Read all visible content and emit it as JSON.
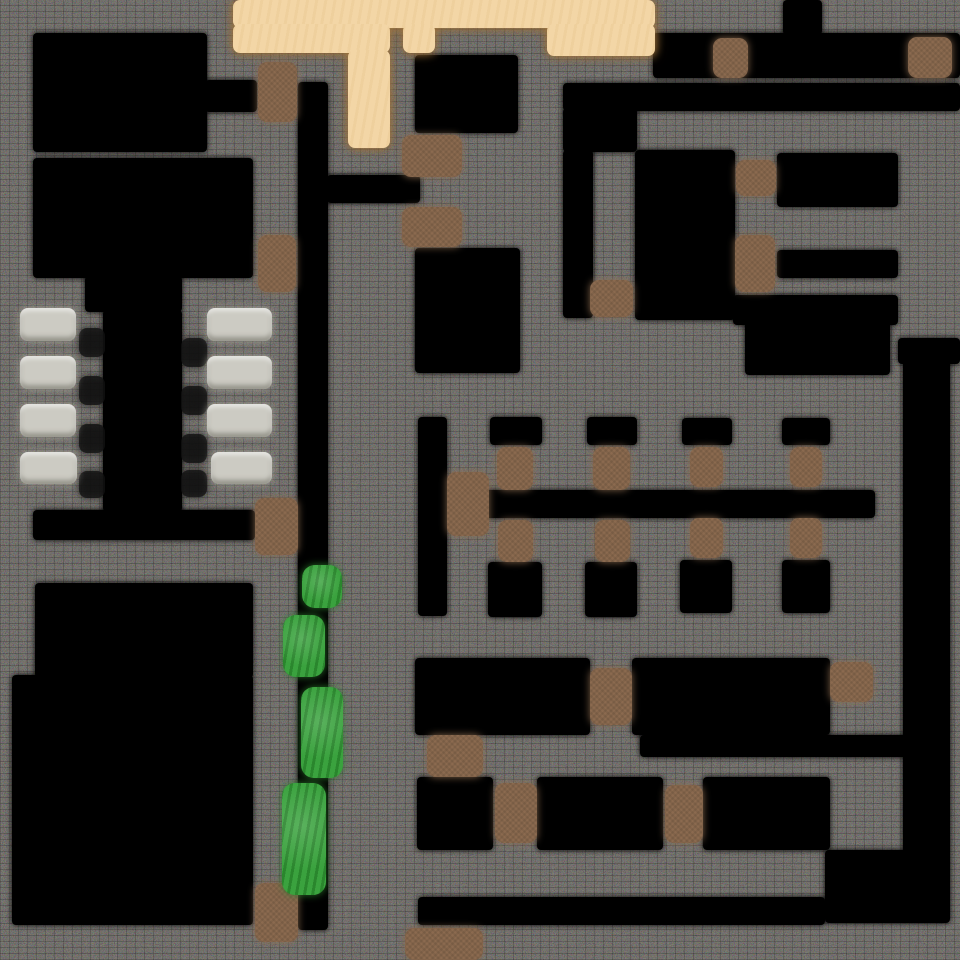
{
  "scene": {
    "title": "top-down tile map",
    "width": 960,
    "height": 960,
    "wall_background": "#1f1e1c"
  },
  "legend": {
    "floor": "room interior / corridor floor",
    "sand": "sandy plaza ground",
    "door": "wooden door",
    "bed": "bed / pew row",
    "bush": "bush shrub",
    "furniture": "small dark furniture"
  },
  "palette": {
    "floor": "#000000",
    "sand": "#f3d6a6",
    "sand_shadow": "#ab7a3d",
    "door": "#8b6a4f",
    "bed": "#cccbc3",
    "bush": "#3aa23e",
    "furniture": "#121212"
  },
  "map": {
    "layers": [
      {
        "id": "floor",
        "kind": "floor",
        "interactable": false,
        "color": "#000000",
        "items": [
          {
            "name": "room-nw-a",
            "rect": [
              33,
              33,
              174,
              119
            ]
          },
          {
            "name": "corridor-nw-door",
            "rect": [
              205,
              80,
              52,
              32
            ]
          },
          {
            "name": "corridor-west-vertical",
            "rect": [
              298,
              82,
              30,
              848
            ]
          },
          {
            "name": "room-nw-b",
            "rect": [
              33,
              158,
              220,
              120
            ]
          },
          {
            "name": "corridor-branch-mid",
            "rect": [
              327,
              175,
              93,
              28
            ]
          },
          {
            "name": "church-aisle-top",
            "rect": [
              85,
              276,
              97,
              36
            ]
          },
          {
            "name": "church-aisle",
            "rect": [
              103,
              310,
              79,
              202
            ]
          },
          {
            "name": "church-south-hall",
            "rect": [
              33,
              510,
              222,
              30
            ]
          },
          {
            "name": "room-sw-a",
            "rect": [
              35,
              583,
              218,
              95
            ]
          },
          {
            "name": "room-sw-b",
            "rect": [
              12,
              675,
              241,
              250
            ]
          },
          {
            "name": "room-mid-a",
            "rect": [
              415,
              55,
              103,
              78
            ]
          },
          {
            "name": "room-mid-b",
            "rect": [
              415,
              248,
              105,
              125
            ]
          },
          {
            "name": "office-vert-corridor",
            "rect": [
              418,
              417,
              29,
              199
            ]
          },
          {
            "name": "office-main-corridor",
            "rect": [
              485,
              490,
              390,
              28
            ]
          },
          {
            "name": "office-cell-a1",
            "rect": [
              490,
              417,
              52,
              28
            ]
          },
          {
            "name": "office-cell-b1",
            "rect": [
              587,
              417,
              50,
              28
            ]
          },
          {
            "name": "office-cell-c1",
            "rect": [
              682,
              418,
              50,
              27
            ]
          },
          {
            "name": "office-cell-d1",
            "rect": [
              782,
              418,
              48,
              27
            ]
          },
          {
            "name": "office-cell-a2",
            "rect": [
              488,
              562,
              54,
              55
            ]
          },
          {
            "name": "office-cell-b2",
            "rect": [
              585,
              562,
              52,
              55
            ]
          },
          {
            "name": "office-cell-c2",
            "rect": [
              680,
              560,
              52,
              53
            ]
          },
          {
            "name": "office-cell-d2",
            "rect": [
              782,
              560,
              48,
              53
            ]
          },
          {
            "name": "corridor-north",
            "rect": [
              653,
              33,
              307,
              45
            ]
          },
          {
            "name": "corridor-north-stub",
            "rect": [
              783,
              0,
              39,
              35
            ]
          },
          {
            "name": "corridor-ne",
            "rect": [
              563,
              83,
              397,
              28
            ]
          },
          {
            "name": "junction-ne",
            "rect": [
              563,
              108,
              74,
              44
            ]
          },
          {
            "name": "corridor-ne-vertical",
            "rect": [
              563,
              150,
              30,
              168
            ]
          },
          {
            "name": "room-ne-tall",
            "rect": [
              635,
              150,
              100,
              170
            ]
          },
          {
            "name": "room-ne-a",
            "rect": [
              777,
              153,
              121,
              54
            ]
          },
          {
            "name": "room-ne-b",
            "rect": [
              777,
              250,
              121,
              28
            ]
          },
          {
            "name": "room-ne-band",
            "rect": [
              733,
              295,
              165,
              30
            ]
          },
          {
            "name": "room-ne-c",
            "rect": [
              745,
              320,
              145,
              55
            ]
          },
          {
            "name": "corridor-east-cap",
            "rect": [
              898,
              338,
              62,
              26
            ]
          },
          {
            "name": "corridor-east-vertical",
            "rect": [
              903,
              338,
              47,
              585
            ]
          },
          {
            "name": "room-se-a",
            "rect": [
              415,
              658,
              175,
              77
            ]
          },
          {
            "name": "room-se-b",
            "rect": [
              632,
              658,
              198,
              77
            ]
          },
          {
            "name": "corridor-se-strip",
            "rect": [
              640,
              735,
              270,
              22
            ]
          },
          {
            "name": "room-se-c",
            "rect": [
              417,
              777,
              76,
              73
            ]
          },
          {
            "name": "room-se-d",
            "rect": [
              537,
              777,
              126,
              73
            ]
          },
          {
            "name": "room-se-e",
            "rect": [
              703,
              777,
              127,
              73
            ]
          },
          {
            "name": "corridor-south",
            "rect": [
              418,
              897,
              407,
              28
            ]
          },
          {
            "name": "corridor-se-corner",
            "rect": [
              825,
              850,
              122,
              73
            ]
          }
        ]
      },
      {
        "id": "sand",
        "kind": "sand",
        "interactable": false,
        "color": "#f3d6a6",
        "items": [
          {
            "name": "plaza-main",
            "rect": [
              233,
              0,
              422,
              28
            ]
          },
          {
            "name": "plaza-left",
            "rect": [
              233,
              24,
              157,
              29
            ]
          },
          {
            "name": "plaza-mid",
            "rect": [
              403,
              24,
              32,
              29
            ]
          },
          {
            "name": "plaza-right",
            "rect": [
              547,
              24,
              108,
              32
            ]
          },
          {
            "name": "plaza-path",
            "rect": [
              348,
              50,
              42,
              98
            ]
          }
        ]
      },
      {
        "id": "furniture",
        "kind": "furniture",
        "interactable": false,
        "color": "#121212",
        "items": [
          {
            "name": "stand-left-1",
            "rect": [
              79,
              328,
              26,
              29
            ]
          },
          {
            "name": "stand-left-2",
            "rect": [
              79,
              376,
              26,
              29
            ]
          },
          {
            "name": "stand-left-3",
            "rect": [
              79,
              424,
              26,
              29
            ]
          },
          {
            "name": "stand-left-4",
            "rect": [
              79,
              471,
              26,
              27
            ]
          },
          {
            "name": "stand-right-1",
            "rect": [
              181,
              338,
              26,
              29
            ]
          },
          {
            "name": "stand-right-2",
            "rect": [
              181,
              386,
              26,
              29
            ]
          },
          {
            "name": "stand-right-3",
            "rect": [
              181,
              434,
              26,
              29
            ]
          },
          {
            "name": "stand-right-4",
            "rect": [
              181,
              470,
              26,
              27
            ]
          }
        ]
      },
      {
        "id": "bed",
        "kind": "bed",
        "interactable": true,
        "color": "#cccbc3",
        "items": [
          {
            "name": "pew-left-1",
            "rect": [
              20,
              308,
              56,
              33
            ]
          },
          {
            "name": "pew-left-2",
            "rect": [
              20,
              356,
              56,
              33
            ]
          },
          {
            "name": "pew-left-3",
            "rect": [
              20,
              404,
              56,
              33
            ]
          },
          {
            "name": "pew-left-4",
            "rect": [
              20,
              452,
              57,
              32
            ]
          },
          {
            "name": "pew-right-1",
            "rect": [
              207,
              308,
              65,
              33
            ]
          },
          {
            "name": "pew-right-2",
            "rect": [
              207,
              356,
              65,
              33
            ]
          },
          {
            "name": "pew-right-3",
            "rect": [
              207,
              404,
              65,
              33
            ]
          },
          {
            "name": "pew-right-4",
            "rect": [
              211,
              452,
              61,
              32
            ]
          }
        ]
      },
      {
        "id": "door",
        "kind": "door",
        "interactable": true,
        "color": "#8b6a4f",
        "items": [
          {
            "name": "door-nw",
            "rect": [
              258,
              62,
              39,
              60
            ]
          },
          {
            "name": "door-north-1",
            "rect": [
              713,
              38,
              35,
              40
            ]
          },
          {
            "name": "door-north-2",
            "rect": [
              908,
              37,
              44,
              41
            ]
          },
          {
            "name": "door-mid-upper",
            "rect": [
              402,
              135,
              60,
              42
            ]
          },
          {
            "name": "door-mid-lower",
            "rect": [
              402,
              207,
              60,
              40
            ]
          },
          {
            "name": "door-west",
            "rect": [
              258,
              235,
              38,
              57
            ]
          },
          {
            "name": "door-ne-junction",
            "rect": [
              590,
              280,
              43,
              37
            ]
          },
          {
            "name": "door-ne-a",
            "rect": [
              736,
              160,
              40,
              36
            ]
          },
          {
            "name": "door-ne-b",
            "rect": [
              735,
              235,
              40,
              57
            ]
          },
          {
            "name": "door-church",
            "rect": [
              255,
              498,
              43,
              57
            ]
          },
          {
            "name": "door-office-main",
            "rect": [
              447,
              472,
              42,
              64
            ]
          },
          {
            "name": "door-office-a1",
            "rect": [
              497,
              447,
              36,
              43
            ]
          },
          {
            "name": "door-office-b1",
            "rect": [
              593,
              447,
              37,
              43
            ]
          },
          {
            "name": "door-office-c1",
            "rect": [
              690,
              447,
              33,
              40
            ]
          },
          {
            "name": "door-office-d1",
            "rect": [
              790,
              447,
              32,
              40
            ]
          },
          {
            "name": "door-office-a2",
            "rect": [
              498,
              520,
              35,
              42
            ]
          },
          {
            "name": "door-office-b2",
            "rect": [
              595,
              520,
              35,
              42
            ]
          },
          {
            "name": "door-office-c2",
            "rect": [
              690,
              518,
              33,
              40
            ]
          },
          {
            "name": "door-office-d2",
            "rect": [
              790,
              518,
              32,
              40
            ]
          },
          {
            "name": "door-se-1",
            "rect": [
              590,
              668,
              42,
              57
            ]
          },
          {
            "name": "door-se-2",
            "rect": [
              830,
              662,
              43,
              40
            ]
          },
          {
            "name": "door-se-3",
            "rect": [
              427,
              735,
              56,
              42
            ]
          },
          {
            "name": "door-se-4",
            "rect": [
              495,
              783,
              42,
              60
            ]
          },
          {
            "name": "door-se-5",
            "rect": [
              665,
              785,
              38,
              58
            ]
          },
          {
            "name": "door-sw",
            "rect": [
              255,
              883,
              43,
              59
            ]
          },
          {
            "name": "door-south-wide",
            "rect": [
              405,
              928,
              78,
              32
            ]
          }
        ]
      },
      {
        "id": "bush",
        "kind": "bush",
        "interactable": false,
        "color": "#3aa23e",
        "items": [
          {
            "name": "bush-1",
            "rect": [
              302,
              565,
              40,
              43
            ]
          },
          {
            "name": "bush-2",
            "rect": [
              283,
              615,
              42,
              62
            ]
          },
          {
            "name": "bush-3",
            "rect": [
              301,
              687,
              42,
              91
            ]
          },
          {
            "name": "bush-4",
            "rect": [
              282,
              783,
              44,
              112
            ]
          }
        ]
      }
    ]
  }
}
